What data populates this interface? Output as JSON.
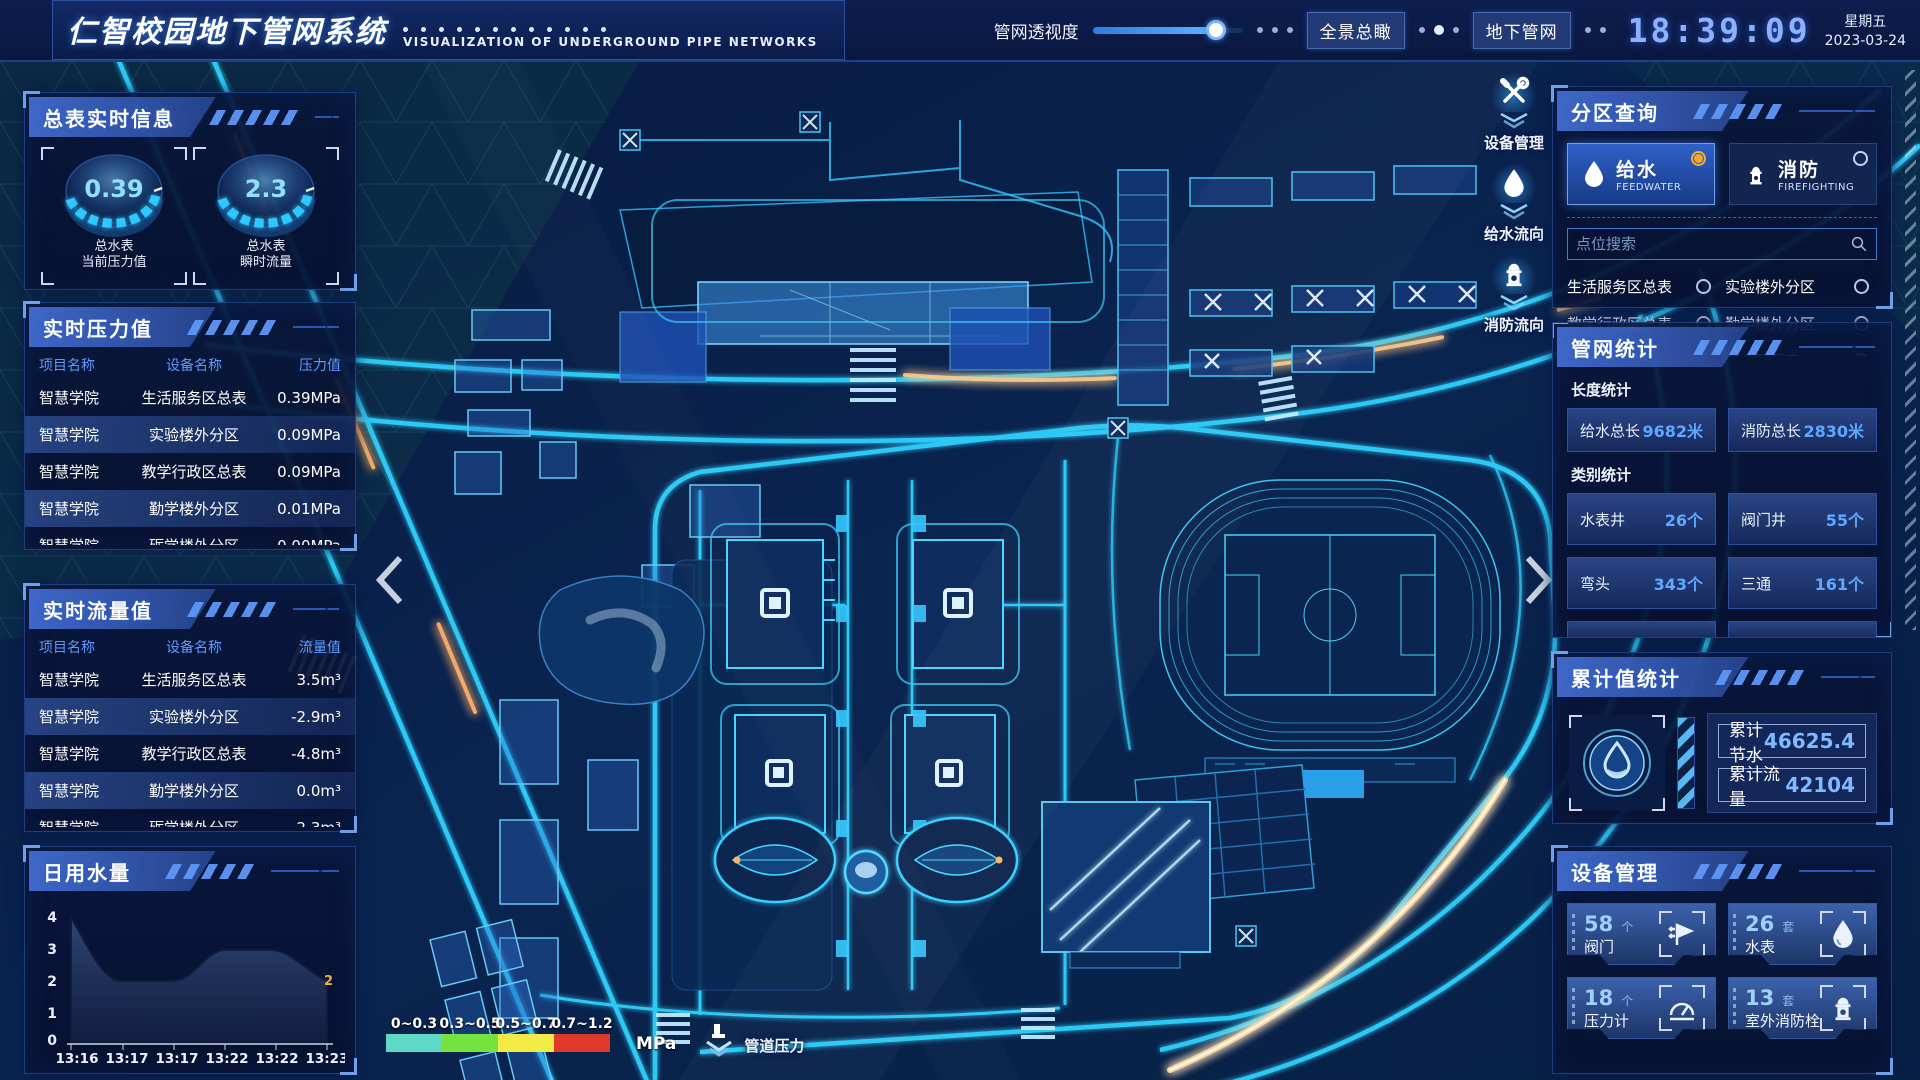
{
  "header": {
    "title": "仁智校园地下管网系统",
    "subtitle": "VISUALIZATION OF UNDERGROUND PIPE NETWORKS",
    "transparency_label": "管网透视度",
    "btn_overview": "全景总瞰",
    "btn_underground": "地下管网",
    "clock": "18:39:09",
    "weekday": "星期五",
    "date": "2023-03-24"
  },
  "theme": {
    "accent_cyan": "#35c8ff",
    "value_blue": "#5fa8ff",
    "warn_yellow": "#e8b33a",
    "panel_bg": "#091636",
    "highlight_row": "#2c4f9e"
  },
  "left": {
    "master_info": {
      "title": "总表实时信息",
      "gauges": [
        {
          "value": "0.39",
          "label1": "总水表",
          "label2": "当前压力值"
        },
        {
          "value": "2.3",
          "label1": "总水表",
          "label2": "瞬时流量"
        }
      ]
    },
    "pressure": {
      "title": "实时压力值",
      "columns": [
        "项目名称",
        "设备名称",
        "压力值"
      ],
      "rows": [
        [
          "智慧学院",
          "生活服务区总表",
          "0.39MPa"
        ],
        [
          "智慧学院",
          "实验楼外分区",
          "0.09MPa"
        ],
        [
          "智慧学院",
          "教学行政区总表",
          "0.09MPa"
        ],
        [
          "智慧学院",
          "勤学楼外分区",
          "0.01MPa"
        ],
        [
          "智慧学院",
          "砺学楼外分区",
          "0.00MPa"
        ]
      ]
    },
    "flow": {
      "title": "实时流量值",
      "columns": [
        "项目名称",
        "设备名称",
        "流量值"
      ],
      "rows": [
        [
          "智慧学院",
          "生活服务区总表",
          "3.5m³"
        ],
        [
          "智慧学院",
          "实验楼外分区",
          "-2.9m³"
        ],
        [
          "智慧学院",
          "教学行政区总表",
          "-4.8m³"
        ],
        [
          "智慧学院",
          "勤学楼外分区",
          "0.0m³"
        ],
        [
          "智慧学院",
          "砺学楼外分区",
          "2.3m³"
        ]
      ]
    },
    "daily": {
      "title": "日用水量"
    }
  },
  "chart_data": {
    "type": "area",
    "title": "日用水量",
    "x": [
      "13:16",
      "13:17",
      "13:17",
      "13:22",
      "13:22",
      "13:23"
    ],
    "values": [
      4,
      2,
      2,
      3,
      3,
      2
    ],
    "yticks": [
      0,
      1,
      2,
      3,
      4
    ],
    "ylim": [
      0,
      4
    ],
    "end_label": "2",
    "grid": false,
    "legend": "none"
  },
  "map": {
    "overlay_tools": [
      {
        "label": "设备管理",
        "icon": "tools-icon"
      },
      {
        "label": "给水流向",
        "icon": "water-drop-icon"
      },
      {
        "label": "消防流向",
        "icon": "hydrant-icon"
      }
    ],
    "legend": {
      "ranges": [
        "0~0.3",
        "0.3~0.5",
        "0.5~0.7",
        "0.7~1.2"
      ],
      "colors": [
        "#5fd8c8",
        "#74e23f",
        "#f2ea45",
        "#e0392b"
      ],
      "unit": "MPa",
      "pressure_label": "管道压力"
    }
  },
  "right": {
    "zone_query": {
      "title": "分区查询",
      "tabs": [
        {
          "label": "给水",
          "sub": "FEEDWATER",
          "selected": true
        },
        {
          "label": "消防",
          "sub": "FIREFIGHTING",
          "selected": false
        }
      ],
      "search_placeholder": "点位搜索",
      "items": [
        "生活服务区总表",
        "实验楼外分区",
        "教学行政区总表",
        "勤学楼外分区",
        "砺学楼外分区",
        "宿舍区泵房"
      ]
    },
    "pipe_stats": {
      "title": "管网统计",
      "length_label": "长度统计",
      "length_stats": [
        {
          "label": "给水总长",
          "value": "9682米"
        },
        {
          "label": "消防总长",
          "value": "2830米"
        }
      ],
      "category_label": "类别统计",
      "category_stats": [
        {
          "label": "水表井",
          "value": "26个"
        },
        {
          "label": "阀门井",
          "value": "55个"
        },
        {
          "label": "弯头",
          "value": "343个"
        },
        {
          "label": "三通",
          "value": "161个"
        }
      ]
    },
    "cumulative": {
      "title": "累计值统计",
      "rows": [
        {
          "label": "累计节水",
          "value": "46625.4"
        },
        {
          "label": "累计流量",
          "value": "42104"
        }
      ]
    },
    "devices": {
      "title": "设备管理",
      "cards": [
        {
          "count": "58",
          "unit": "个",
          "label": "阀门",
          "icon": "valve-icon"
        },
        {
          "count": "26",
          "unit": "套",
          "label": "水表",
          "icon": "water-meter-icon"
        },
        {
          "count": "18",
          "unit": "个",
          "label": "压力计",
          "icon": "pressure-gauge-icon"
        },
        {
          "count": "13",
          "unit": "套",
          "label": "室外消防栓",
          "icon": "hydrant-icon"
        }
      ]
    }
  }
}
